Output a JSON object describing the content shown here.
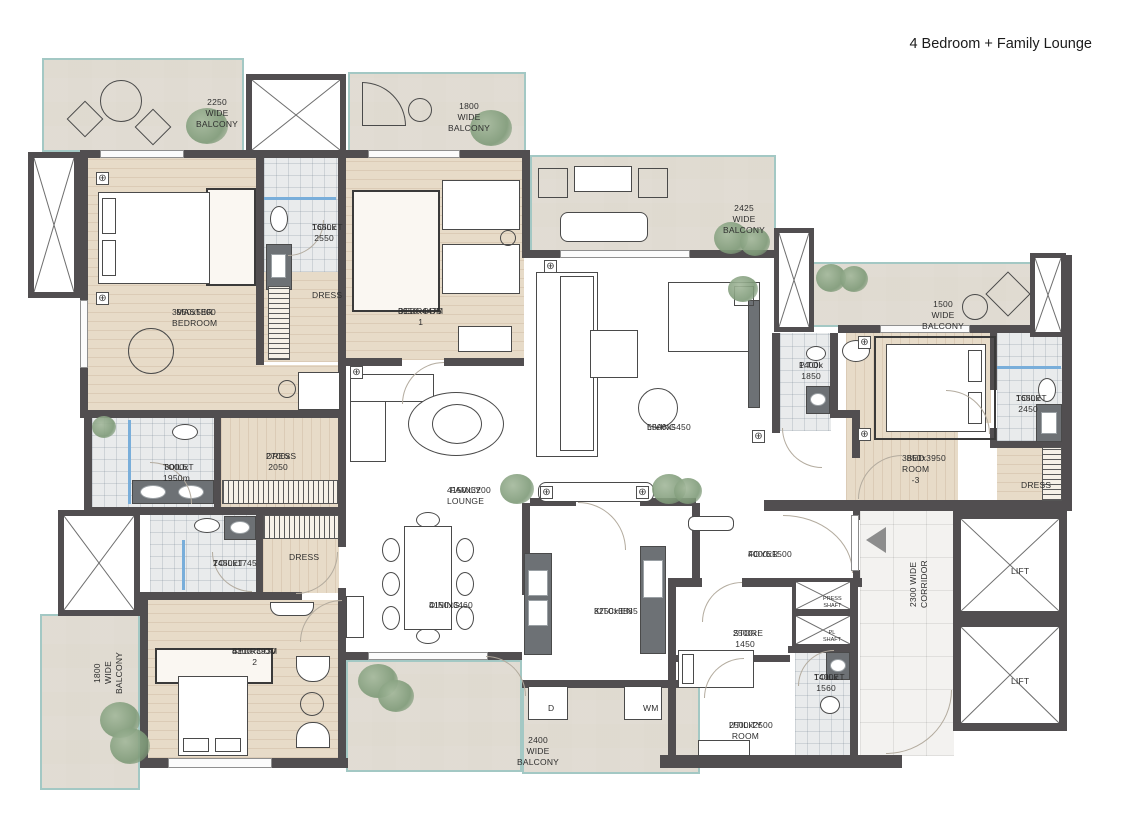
{
  "title": "4 Bedroom + Family Lounge",
  "colors": {
    "wall": "#514e50",
    "balcony_edge": "#a3c8c4",
    "wood_floor": "#e7dbc8",
    "tile_floor": "#e9ebec",
    "living_floor": "#ece5d8",
    "glass_accent": "#79aeda",
    "plant": "#7e9a78"
  },
  "rooms": {
    "master_bedroom": {
      "name": "MASTER BEDROOM",
      "dim": "3950x5800"
    },
    "toilet_master_upper": {
      "name": "TOILET",
      "dim": "1650x\n2550"
    },
    "dress_bedroom1": {
      "name": "DRESS",
      "dim": ""
    },
    "bedroom1": {
      "name": "BEDROOM 1",
      "dim": "3950x4475"
    },
    "living": {
      "name": "LIVING",
      "dim": "5500x5450"
    },
    "powder_toilet": {
      "name": "P.TOI",
      "dim": "1400x\n1850"
    },
    "bedroom3": {
      "name": "BED ROOM -3",
      "dim": "3850x3950"
    },
    "toilet_bedroom3": {
      "name": "TOILET",
      "dim": "1650x\n2450"
    },
    "dress_bedroom3": {
      "name": "DRESS",
      "dim": ""
    },
    "toilet_master_lower": {
      "name": "TOILET",
      "dim": "3000x 1950m"
    },
    "dress_master": {
      "name": "DRESS",
      "dim": "2700x\n2050"
    },
    "family_lounge": {
      "name": "FAMILY LOUNGE",
      "dim": "4150x3200"
    },
    "toilet_bedroom2": {
      "name": "TOILET",
      "dim": "2450x1745"
    },
    "dress_bedroom2": {
      "name": "DRESS",
      "dim": ""
    },
    "bedroom2": {
      "name": "BEDROOM 2",
      "dim": "4300x3930"
    },
    "dining": {
      "name": "DINING",
      "dim": "4150x3460"
    },
    "kitchen": {
      "name": "KITCHEN",
      "dim": "3250x3885"
    },
    "foyer": {
      "name": "FOYER",
      "dim": "4000x1500"
    },
    "store": {
      "name": "STORE",
      "dim": "2500x\n1450"
    },
    "utility": {
      "name": "UTILITY ROOM",
      "dim": "2500x2500"
    },
    "toilet_utility": {
      "name": "TOILET",
      "dim": "1400x\n1560"
    }
  },
  "zones": {
    "press_shaft": "PRESS SHAFT",
    "pl_shaft": "PL SHAFT",
    "corridor": "2300 WIDE CORRIDOR",
    "lift": "LIFT"
  },
  "balconies": {
    "top_left": "2250 WIDE BALCONY",
    "top": "1800 WIDE BALCONY",
    "living": "2425 WIDE BALCONY",
    "right": "1500 WIDE BALCONY",
    "left": "1800 WIDE BALCONY",
    "bottom": "2400 WIDE BALCONY"
  },
  "appliances": {
    "dishwasher": "D",
    "washing_machine": "WM"
  }
}
